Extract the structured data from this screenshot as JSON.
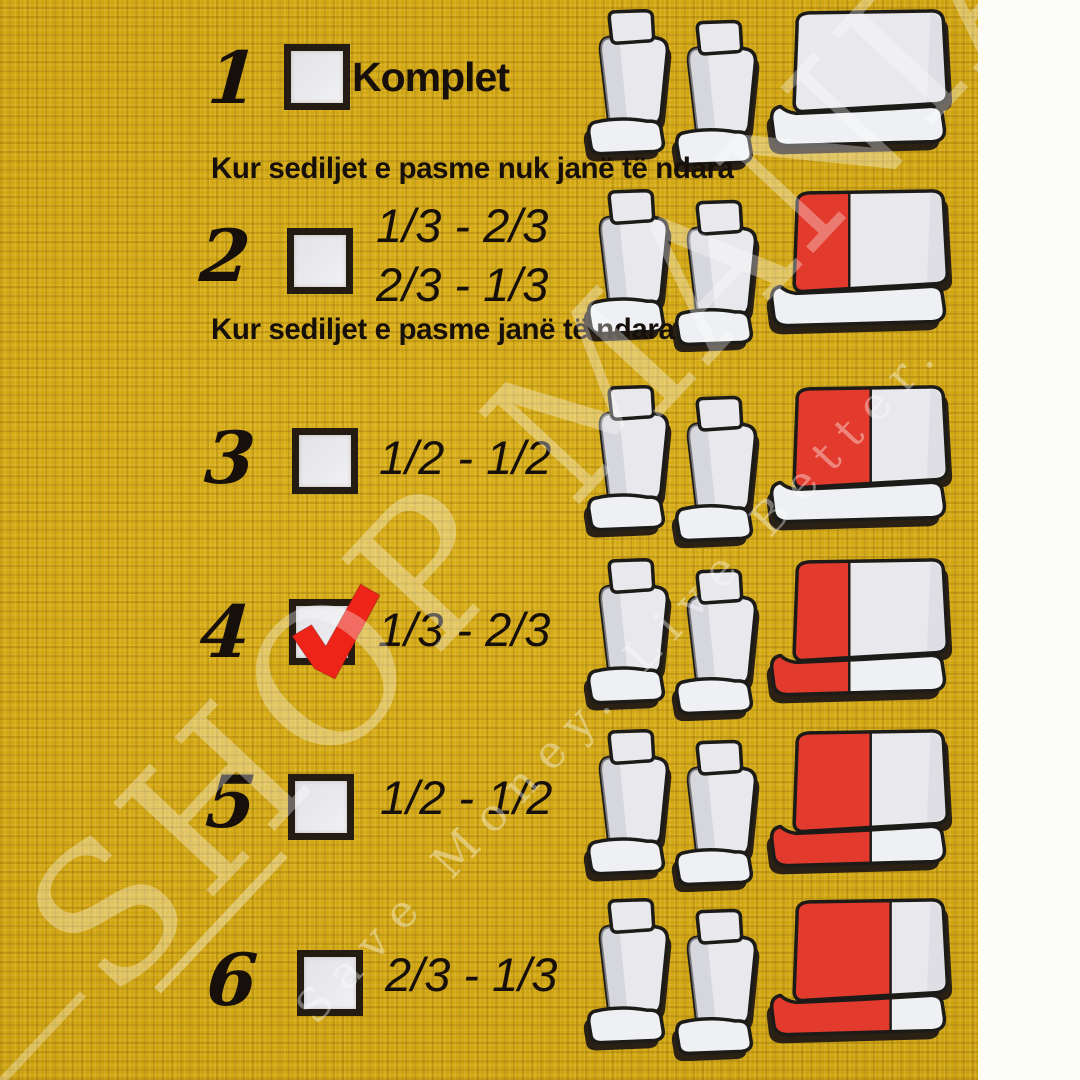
{
  "colors": {
    "background_fabric": "#d0a411",
    "paper_white": "#fcfcf8",
    "ink": "#17100a",
    "checkbox_fill": "#eae9ed",
    "checkbox_border": "#241c12",
    "checkmark_red": "#ee2418",
    "seat_fill": "#e9e9ed",
    "seat_shade": "#c7c7d0",
    "seat_outline": "#1d1b18",
    "seat_shadow": "#2a2014",
    "cover_red": "#e23a2c"
  },
  "subtitles": {
    "not_divided": "Kur sediljet e pasme nuk janë të ndara",
    "divided": "Kur sediljet e pasme janë të ndara"
  },
  "watermark": {
    "line1": "SHOP MANIA",
    "line2": "Save Money. Live Better."
  },
  "rows": [
    {
      "num": "1",
      "checked": false,
      "labels": [
        "Komplet"
      ],
      "bench": {
        "red_fraction": 0,
        "red_covers": "none"
      }
    },
    {
      "num": "2",
      "checked": false,
      "labels": [
        "1/3 - 2/3",
        "2/3 - 1/3"
      ],
      "bench": {
        "red_fraction": 0.36,
        "red_covers": "backrest"
      }
    },
    {
      "num": "3",
      "checked": false,
      "labels": [
        "1/2 - 1/2"
      ],
      "bench": {
        "red_fraction": 0.5,
        "red_covers": "backrest"
      }
    },
    {
      "num": "4",
      "checked": true,
      "labels": [
        "1/3 - 2/3"
      ],
      "bench": {
        "red_fraction": 0.36,
        "red_covers": "full"
      }
    },
    {
      "num": "5",
      "checked": false,
      "labels": [
        "1/2 - 1/2"
      ],
      "bench": {
        "red_fraction": 0.5,
        "red_covers": "full"
      }
    },
    {
      "num": "6",
      "checked": false,
      "labels": [
        "2/3 - 1/3"
      ],
      "bench": {
        "red_fraction": 0.63,
        "red_covers": "full"
      }
    }
  ]
}
